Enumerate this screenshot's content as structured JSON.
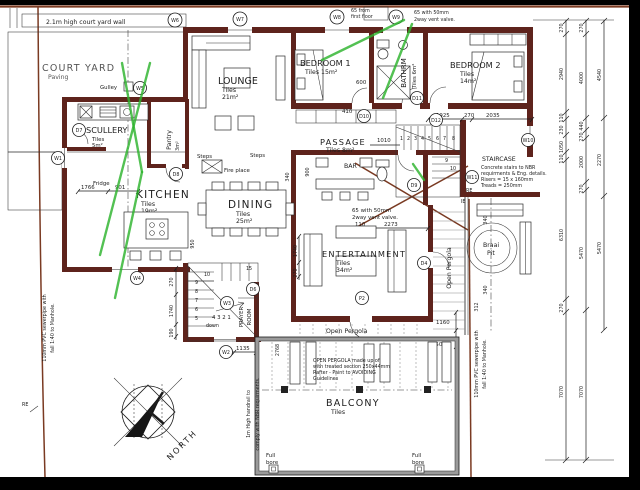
{
  "colors": {
    "paper": "#ffffff",
    "ink": "#1c1c1c",
    "wall": "#5e231c",
    "boundary": "#7a3a22",
    "annotation": "#2db32d"
  },
  "rooms": {
    "court_yard": {
      "name": "COURT YARD",
      "finish": "Paving"
    },
    "lounge": {
      "name": "LOUNGE",
      "l1": "Tiles",
      "l2": "21m²"
    },
    "bedroom1": {
      "name": "BEDROOM 1",
      "l1": "Tiles 15m²"
    },
    "bathroom": {
      "name": "BATHRM",
      "l1": "Tiles 6m²"
    },
    "bedroom2": {
      "name": "BEDROOM 2",
      "l1": "Tiles",
      "l2": "14m²"
    },
    "passage": {
      "name": "PASSAGE",
      "l1": "Tiles 8m²"
    },
    "scullery": {
      "name": "SCULLERY",
      "l1": "Tiles",
      "l2": "5m²"
    },
    "pantry": {
      "name": "Pantry",
      "l1": "3m²"
    },
    "kitchen": {
      "name": "KITCHEN",
      "l1": "Tiles",
      "l2": "19m²"
    },
    "dining": {
      "name": "DINING",
      "l1": "Tiles",
      "l2": "25m²"
    },
    "bar": {
      "name": "BAR"
    },
    "entertainment": {
      "name": "ENTERTAINMENT",
      "l1": "Tiles",
      "l2": "34m²"
    },
    "prayer": {
      "name1": "PRAYER",
      "name2": "ROOM"
    },
    "balcony": {
      "name": "BALCONY",
      "l1": "Tiles"
    },
    "pergola_bottom": {
      "name": "Open Pergola"
    },
    "pergola_right": {
      "name": "Open Pergola"
    },
    "braai": {
      "name1": "Braai",
      "name2": "Pit"
    }
  },
  "notes": {
    "court_wall": "2.1m high court yard wall",
    "first_floor": [
      "65 from",
      "first floor"
    ],
    "vent_top": [
      "65 with 50mm",
      "2way vent valve."
    ],
    "vent_mid": [
      "65 with 50mm",
      "2way vent valve."
    ],
    "staircase": [
      "STAIRCASE",
      "Concrete stairs to NBR",
      "requirments & Eng. details.",
      "Risers = 15 x 160mm",
      "Treads = 250mm"
    ],
    "pergola": [
      "OPEN PERGOLA made up of",
      "with treated section 250x44mm",
      "Rafter - Paint to AVOIDING",
      "Guidelines"
    ],
    "sewer": [
      "110mm PVC sewerpipe with",
      "fall 1:40 to Manhole."
    ],
    "handrail": [
      "1m High handrail to",
      "comply with NBR requirments."
    ],
    "gulley": "Gulley",
    "fridge": "Fridge",
    "fire_place": "Fire place",
    "steps": "Steps",
    "down": "down",
    "full_bore": [
      "Full",
      "bore"
    ],
    "north": "NORTH",
    "re": "RE",
    "ie": "IE"
  },
  "markers": {
    "w1": "W1",
    "w2": "W2",
    "w3": "W3",
    "w4": "W4",
    "w5": "W5",
    "w6": "W6",
    "w7": "W7",
    "w8": "W8",
    "w9": "W9",
    "w10": "W10",
    "w11": "W11",
    "d4": "D4",
    "d6": "D6",
    "d7": "D7",
    "d8": "D8",
    "d9": "D9",
    "d10": "D10",
    "d11": "D11",
    "d12": "D12",
    "p2": "P2"
  },
  "dims": {
    "c1": [
      "270",
      "2940",
      "110",
      "230",
      "1050",
      "110",
      "6310",
      "270",
      "7070"
    ],
    "c2": [
      "270",
      "4000",
      "440",
      "270",
      "2000",
      "270",
      "5470",
      "7070"
    ],
    "c3": [
      "4540",
      "2270",
      "5470"
    ],
    "passage": "1010",
    "bathroom": "600",
    "bedroom1": "410",
    "bedroom2": [
      "1925",
      "270",
      "2035"
    ],
    "kitchen": [
      "1766",
      "901"
    ],
    "island": "950",
    "bar": "900",
    "entertainment": [
      "110",
      "2273"
    ],
    "ent_left": [
      "1740",
      "270"
    ],
    "stair_left": [
      "270",
      "1740",
      "190"
    ],
    "prayer": "1135",
    "balcony": "2768",
    "pergola_right": [
      "1160",
      "1500"
    ],
    "braai": [
      "340",
      "340"
    ],
    "edge": "312",
    "fireplace": "340"
  },
  "stairs": {
    "top": [
      "1",
      "2",
      "3",
      "4",
      "5",
      "6",
      "7",
      "8",
      "9",
      "10"
    ],
    "flight": "15",
    "left": [
      "10",
      "9",
      "8",
      "7",
      "6",
      "5"
    ],
    "row": "4 3 2 1"
  }
}
